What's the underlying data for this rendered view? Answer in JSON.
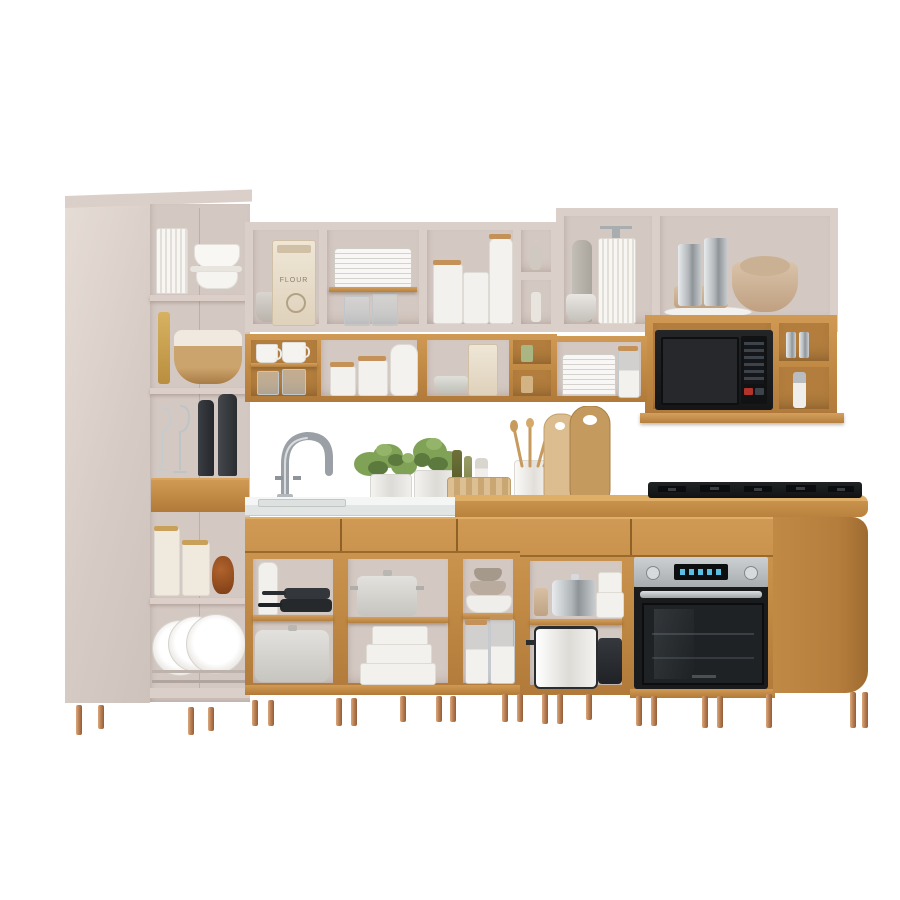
{
  "image_type": "product-photo",
  "subject": "l-shaped-modular-kitchen-cabinet-set-with-open-shelving",
  "labels": {
    "flour_bag": "FLOUR"
  },
  "palette": {
    "background": "#ffffff",
    "cabinet_cream": "#dbcfc9",
    "cabinet_interior": "#d4c8c2",
    "wood_tone": "#bf8843",
    "wood_light": "#d09a55",
    "counter_white": "#f4f6f5",
    "leg_copper": "#b97e52",
    "appliance_black": "#1a1c1e",
    "appliance_steel": "#b8bcbf",
    "oven_display_blue": "#57c0e4",
    "plant_green": "#7fa257"
  },
  "appliances": [
    "microwave",
    "built-in-oven",
    "gas-cooktop"
  ],
  "modules": [
    "tall-pantry-cabinet",
    "upper-wall-cabinets-left",
    "upper-wall-cabinets-right",
    "microwave-wall-cabinet",
    "sink-base-cabinet",
    "base-open-shelves",
    "oven-base-cabinet",
    "cooktop-counter"
  ],
  "accessories": [
    "stacked-plates",
    "cups-and-mugs",
    "canisters",
    "flour-bag",
    "wine-glasses",
    "herb-plants",
    "cutting-boards",
    "utensil-crock",
    "woven-basket",
    "stock-pots",
    "frying-pans",
    "glass-jars",
    "metallic-canisters",
    "bowls"
  ]
}
